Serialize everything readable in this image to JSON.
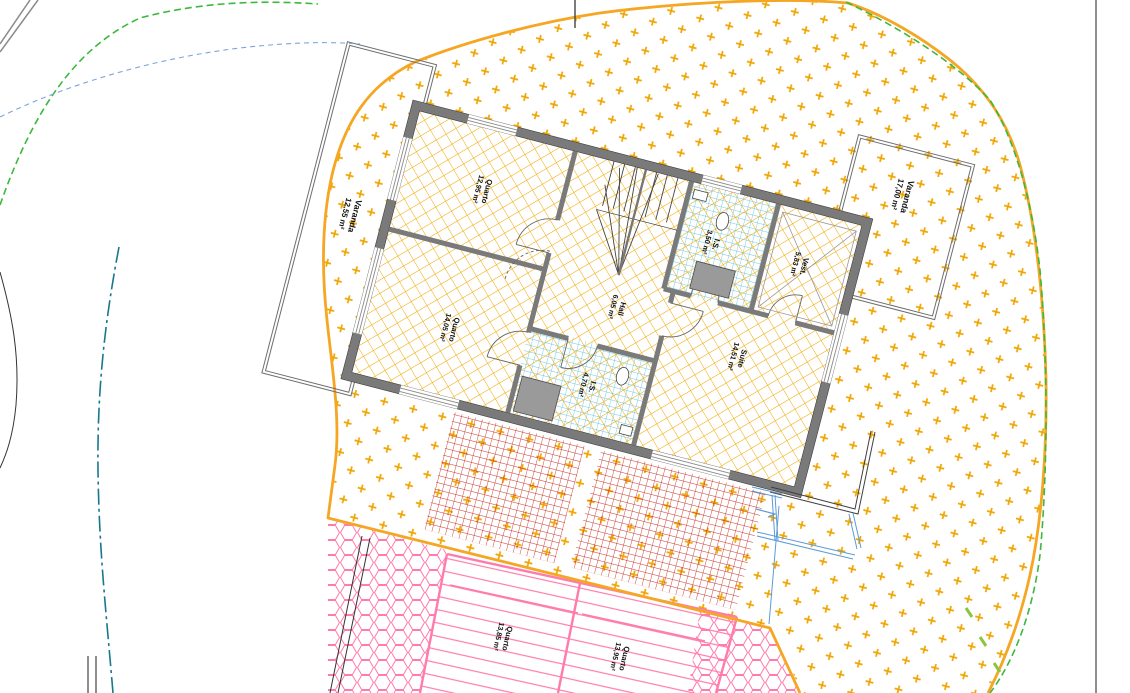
{
  "drawing_title": "Planta - Piso (plantas de arquitetura)",
  "palette": {
    "boundary_orange": "#F5A623",
    "cross_orange": "#F0A500",
    "grid_yellow": "#F0A800",
    "wall_gray": "#7A7A7A",
    "wall_edge": "#3F3F3F",
    "tile_blue": "#45B8E0",
    "paving_red": "#C9342B",
    "pink": "#FF7BAC",
    "green_dash": "#3CB83C",
    "teal_dashdot": "#17788C",
    "blue_dash": "#7BA7DC",
    "outline_gray": "#6E6E6E",
    "plumbing_blue": "#5B9BD5",
    "lime_tick": "#8CC63F",
    "text": "#111111"
  },
  "rooms": [
    {
      "id": "varanda-left",
      "name": "Varanda",
      "area": "12,55 m²"
    },
    {
      "id": "quarto-1",
      "name": "Quarto",
      "area": "12,95 m²"
    },
    {
      "id": "quarto-2",
      "name": "Quarto",
      "area": "14,05 m²"
    },
    {
      "id": "hall",
      "name": "Hall",
      "area": "6,05 m²"
    },
    {
      "id": "is-1",
      "name": "I.S.",
      "area": "3,50 m²"
    },
    {
      "id": "is-2",
      "name": "I.S.",
      "area": "4,70 m²"
    },
    {
      "id": "vest",
      "name": "Vest.",
      "area": "5,83 m²"
    },
    {
      "id": "suite",
      "name": "Suite",
      "area": "14,51 m²"
    },
    {
      "id": "varanda-right",
      "name": "Varanda",
      "area": "17,00 m²"
    },
    {
      "id": "quarto-3",
      "name": "Quarto",
      "area": "13,85 m²"
    },
    {
      "id": "quarto-4",
      "name": "Quarto",
      "area": "13,95 m²"
    }
  ]
}
